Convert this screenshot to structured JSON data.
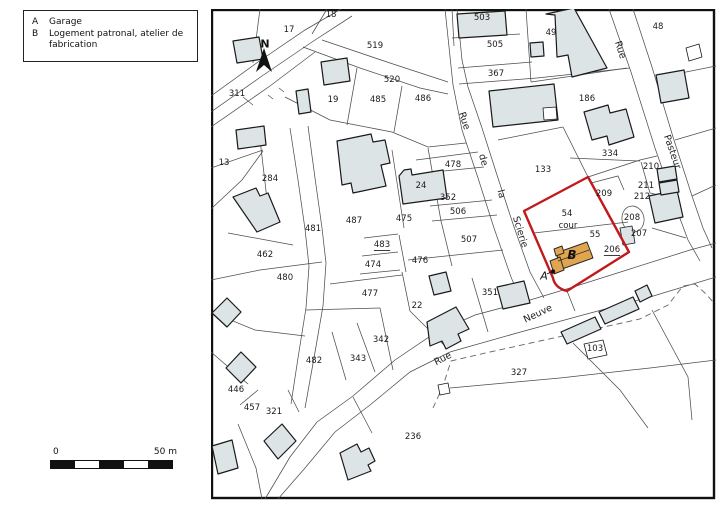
{
  "legend": {
    "items": [
      {
        "key": "A",
        "label": "Garage"
      },
      {
        "key": "B",
        "label": "Logement patronal, atelier de fabrication"
      }
    ]
  },
  "scale_bar": {
    "start_label": "0",
    "end_label": "50 m"
  },
  "north_label": "N",
  "map": {
    "colors": {
      "building_fill": "#dde4e6",
      "highlight_building_fill": "#e0a54e",
      "highlight_outline": "#c2191c",
      "parcel_line": "#4d4d4d",
      "frame": "#111111"
    },
    "parcel_labels": [
      {
        "t": "18",
        "x": 331,
        "y": 15
      },
      {
        "t": "17",
        "x": 289,
        "y": 30
      },
      {
        "t": "311",
        "x": 237,
        "y": 94
      },
      {
        "t": "519",
        "x": 375,
        "y": 46
      },
      {
        "t": "520",
        "x": 392,
        "y": 80
      },
      {
        "t": "19",
        "x": 333,
        "y": 100
      },
      {
        "t": "485",
        "x": 378,
        "y": 100
      },
      {
        "t": "486",
        "x": 423,
        "y": 99
      },
      {
        "t": "503",
        "x": 482,
        "y": 18
      },
      {
        "t": "505",
        "x": 495,
        "y": 45
      },
      {
        "t": "49",
        "x": 551,
        "y": 33
      },
      {
        "t": "48",
        "x": 658,
        "y": 27
      },
      {
        "t": "367",
        "x": 496,
        "y": 74
      },
      {
        "t": "186",
        "x": 587,
        "y": 99
      },
      {
        "t": "334",
        "x": 610,
        "y": 154
      },
      {
        "t": "210",
        "x": 651,
        "y": 167
      },
      {
        "t": "211",
        "x": 646,
        "y": 186
      },
      {
        "t": "212",
        "x": 642,
        "y": 197
      },
      {
        "t": "209",
        "x": 604,
        "y": 194
      },
      {
        "t": "208",
        "x": 632,
        "y": 218
      },
      {
        "t": "207",
        "x": 639,
        "y": 234
      },
      {
        "t": "206",
        "x": 612,
        "y": 250,
        "u": true
      },
      {
        "t": "54",
        "x": 567,
        "y": 214
      },
      {
        "t": "cour",
        "x": 568,
        "y": 226
      },
      {
        "t": "55",
        "x": 595,
        "y": 235
      },
      {
        "t": "133",
        "x": 543,
        "y": 170
      },
      {
        "t": "13",
        "x": 224,
        "y": 163
      },
      {
        "t": "284",
        "x": 270,
        "y": 179
      },
      {
        "t": "487",
        "x": 354,
        "y": 221
      },
      {
        "t": "478",
        "x": 453,
        "y": 165
      },
      {
        "t": "475",
        "x": 404,
        "y": 219
      },
      {
        "t": "24",
        "x": 421,
        "y": 186
      },
      {
        "t": "352",
        "x": 448,
        "y": 198
      },
      {
        "t": "506",
        "x": 458,
        "y": 212
      },
      {
        "t": "507",
        "x": 469,
        "y": 240
      },
      {
        "t": "483",
        "x": 382,
        "y": 245,
        "u": true
      },
      {
        "t": "474",
        "x": 373,
        "y": 265
      },
      {
        "t": "476",
        "x": 420,
        "y": 261
      },
      {
        "t": "481",
        "x": 313,
        "y": 229
      },
      {
        "t": "462",
        "x": 265,
        "y": 255
      },
      {
        "t": "480",
        "x": 285,
        "y": 278
      },
      {
        "t": "477",
        "x": 370,
        "y": 294
      },
      {
        "t": "22",
        "x": 417,
        "y": 306
      },
      {
        "t": "351",
        "x": 490,
        "y": 293
      },
      {
        "t": "342",
        "x": 381,
        "y": 340
      },
      {
        "t": "343",
        "x": 358,
        "y": 359
      },
      {
        "t": "482",
        "x": 314,
        "y": 361
      },
      {
        "t": "446",
        "x": 236,
        "y": 390
      },
      {
        "t": "457",
        "x": 252,
        "y": 408
      },
      {
        "t": "321",
        "x": 274,
        "y": 412
      },
      {
        "t": "236",
        "x": 413,
        "y": 437
      },
      {
        "t": "327",
        "x": 519,
        "y": 373
      },
      {
        "t": "103",
        "x": 595,
        "y": 349
      }
    ],
    "street_labels": [
      {
        "t": "Rue",
        "x": 464,
        "y": 121,
        "r": 72
      },
      {
        "t": "de",
        "x": 483,
        "y": 160,
        "r": 75
      },
      {
        "t": "la",
        "x": 501,
        "y": 194,
        "r": 75
      },
      {
        "t": "Scierie",
        "x": 520,
        "y": 232,
        "r": 73
      },
      {
        "t": "Rue",
        "x": 620,
        "y": 50,
        "r": 72
      },
      {
        "t": "Pasteur",
        "x": 672,
        "y": 152,
        "r": 71
      },
      {
        "t": "Rue",
        "x": 443,
        "y": 359,
        "r": -27
      },
      {
        "t": "Neuve",
        "x": 538,
        "y": 314,
        "r": -25
      }
    ],
    "annotations": [
      {
        "t": "A",
        "x": 544,
        "y": 276,
        "cls": "alabel"
      },
      {
        "t": "B",
        "x": 572,
        "y": 255,
        "cls": "blabel"
      }
    ]
  }
}
